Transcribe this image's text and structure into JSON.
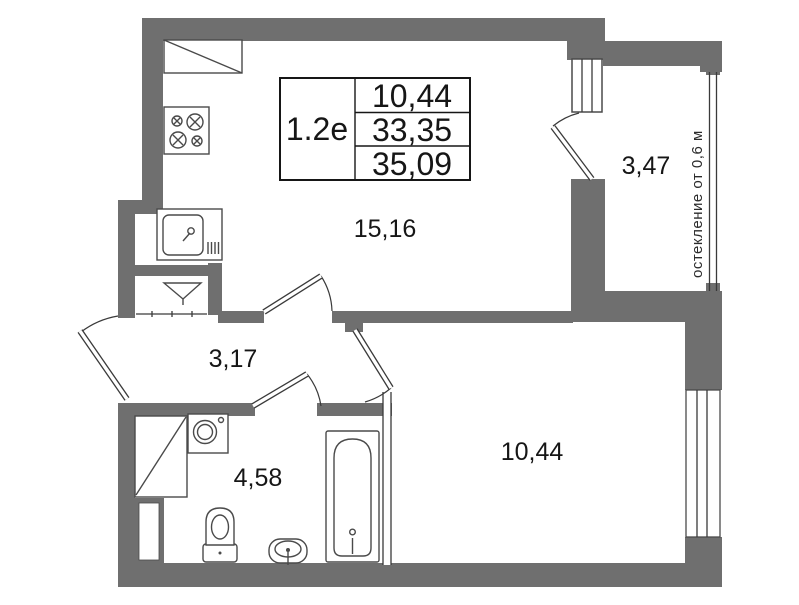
{
  "info_table": {
    "unit_code": "1.2е",
    "values": [
      "10,44",
      "33,35",
      "35,09"
    ]
  },
  "room_labels": {
    "kitchen_living": "15,16",
    "hallway": "3,17",
    "bathroom": "4,58",
    "bedroom": "10,44",
    "balcony": "3,47"
  },
  "notes": {
    "glazing": "остекление от 0,6 м"
  },
  "colors": {
    "wall": "#6f6f6f",
    "line": "#3a3a3a",
    "text": "#161616",
    "background": "#ffffff"
  },
  "fixtures": [
    "kitchen-counter",
    "stove",
    "kitchen-sink",
    "ventilation-shaft",
    "cabinet",
    "washing-machine",
    "toilet",
    "washbasin",
    "bathtub"
  ]
}
